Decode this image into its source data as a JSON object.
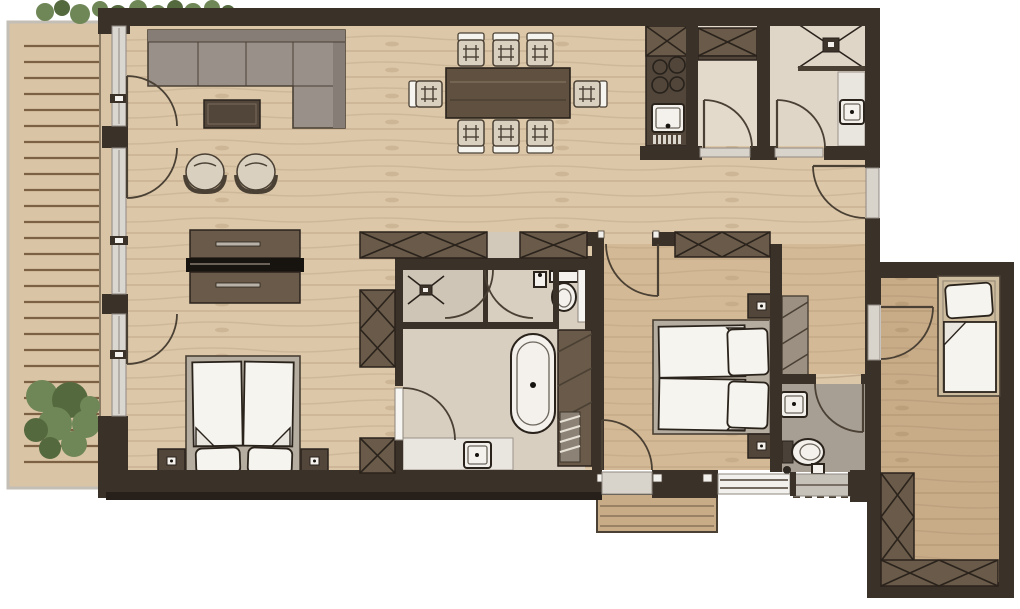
{
  "document": {
    "title": "Apartment floor plan",
    "view": "top-down architectural drawing",
    "canvas": {
      "width": 1020,
      "height": 609
    }
  },
  "palette": {
    "wall": "#3a3129",
    "wall-edge": "#27201a",
    "ink": "#2a231c",
    "ink-soft": "#4a4034",
    "floor-light": "#dcc7a8",
    "floor-mid": "#d3b995",
    "floor-deep": "#c8ac88",
    "deck": "#d9c4a5",
    "deck-line": "#7c6142",
    "deck-edge": "#c3beb6",
    "glass": "#dad6d0",
    "glass-frame": "#8f8a82",
    "threshold": "#d8d3cb",
    "niche": "#d2c9bb",
    "bath-floor": "#d8cfc1",
    "bath-zone": "#cfc5b6",
    "wc-floor": "#a89f94",
    "store-floor": "#e3dacc",
    "store-floor2": "#e0d6c8",
    "furn-dark": "#6a5a49",
    "furn-deep": "#52463a",
    "sofa": "#99908a",
    "sofa-back": "#867d76",
    "chair": "#d9d0c0",
    "table-wood": "#5f5040",
    "tv-black": "#17130f",
    "linen": "#f6f4ee",
    "linen-shade": "#e9e6df",
    "bed-frame": "#b5ad9f",
    "bed-frame-annex": "#cdbc9e",
    "plant": "#6f8757",
    "plant-dark": "#55693f"
  },
  "legend": {
    "rooms": [
      {
        "name": "terrace",
        "features": [
          "wood deck boards",
          "shrub",
          "top hedge",
          "glass wall with three doors"
        ]
      },
      {
        "name": "living-room",
        "furniture": [
          "l-shaped-sofa",
          "coffee-table",
          "armchair",
          "armchair",
          "tv-sideboard"
        ]
      },
      {
        "name": "dining-area",
        "furniture": [
          "dining-table",
          "dining-chair x8"
        ]
      },
      {
        "name": "kitchen",
        "furniture": [
          "kitchenette-counter",
          "cooktop-4-burners",
          "sink-with-drainer",
          "upper-cabinet"
        ]
      },
      {
        "name": "storage-room",
        "furniture": [
          "wardrobe"
        ]
      },
      {
        "name": "utility-shower-room",
        "furniture": [
          "shower",
          "shelf",
          "washbasin"
        ]
      },
      {
        "name": "hallway",
        "features": [
          "entrance-door",
          "built-in-closets"
        ]
      },
      {
        "name": "sleeping-area-1",
        "furniture": [
          "double-bed",
          "nightstand x2",
          "wardrobe"
        ]
      },
      {
        "name": "bathroom",
        "furniture": [
          "shower-with-double-doors",
          "toilet",
          "freestanding-bathtub",
          "vanity-washbasin",
          "shelf-unit",
          "towel-ladder",
          "pocket-door"
        ]
      },
      {
        "name": "bedroom-2",
        "furniture": [
          "double-bed",
          "nightstand x2",
          "wardrobe",
          "open-shelf"
        ]
      },
      {
        "name": "wc",
        "furniture": [
          "toilet",
          "washbasin",
          "floor-drain"
        ]
      },
      {
        "name": "annex-room",
        "furniture": [
          "single-bed",
          "l-shaped-wardrobe"
        ]
      },
      {
        "name": "outdoor-step",
        "features": [
          "wood-platform",
          "dashed-overhang-line"
        ]
      }
    ],
    "counts": {
      "door-swings": 13,
      "window-sections": 6,
      "beds": 3,
      "dining-chairs": 8,
      "armchairs": 2
    }
  }
}
